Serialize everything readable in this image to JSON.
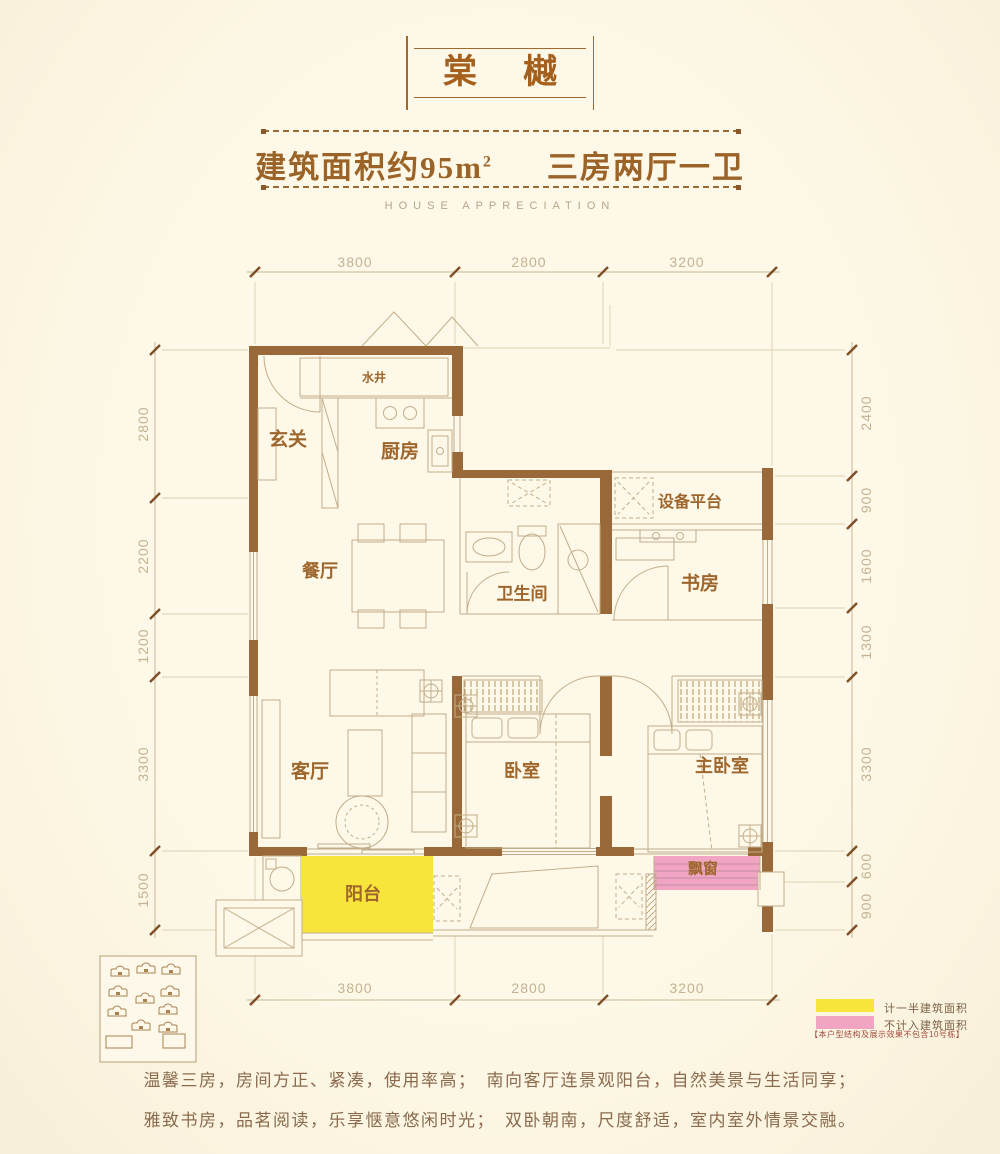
{
  "header": {
    "title": "棠樾",
    "area_prefix": "建筑面积约95m",
    "area_sup": "2",
    "layout_text": "三房两厅一卫",
    "subtitle": "HOUSE APPRECIATION"
  },
  "rooms": {
    "entrance": "玄关",
    "water_shaft": "水井",
    "kitchen": "厨房",
    "equipment_platform": "设备平台",
    "dining": "餐厅",
    "bathroom": "卫生间",
    "study": "书房",
    "living": "客厅",
    "bedroom": "卧室",
    "master_bedroom": "主卧室",
    "balcony": "阳台",
    "bay_window": "飘窗"
  },
  "dimensions": {
    "top": [
      "3800",
      "2800",
      "3200"
    ],
    "bottom": [
      "3800",
      "2800",
      "3200"
    ],
    "left": [
      "2800",
      "2200",
      "1200",
      "3300",
      "1500"
    ],
    "right": [
      "2400",
      "900",
      "1600",
      "1300",
      "3300",
      "600",
      "900"
    ]
  },
  "legend": {
    "half_area_label": "计一半建筑面积",
    "excluded_label": "不计入建筑面积",
    "note": "【本户型结构及展示效果不包含10号栋】",
    "half_area_color": "#f8e53c",
    "excluded_color": "#f2a5c2"
  },
  "description": {
    "line1": "温馨三房，房间方正、紧凑，使用率高；　南向客厅连景观阳台，自然美景与生活同享；",
    "line2": "雅致书房，品茗阅读，乐享惬意悠闲时光；　双卧朝南，尺度舒适，室内室外情景交融。"
  },
  "colors": {
    "background": "#fcf5e0",
    "wall": "#996939",
    "accent_text": "#9e662c",
    "dimension_text": "#c4b292",
    "thin_line": "#bfae8e"
  }
}
